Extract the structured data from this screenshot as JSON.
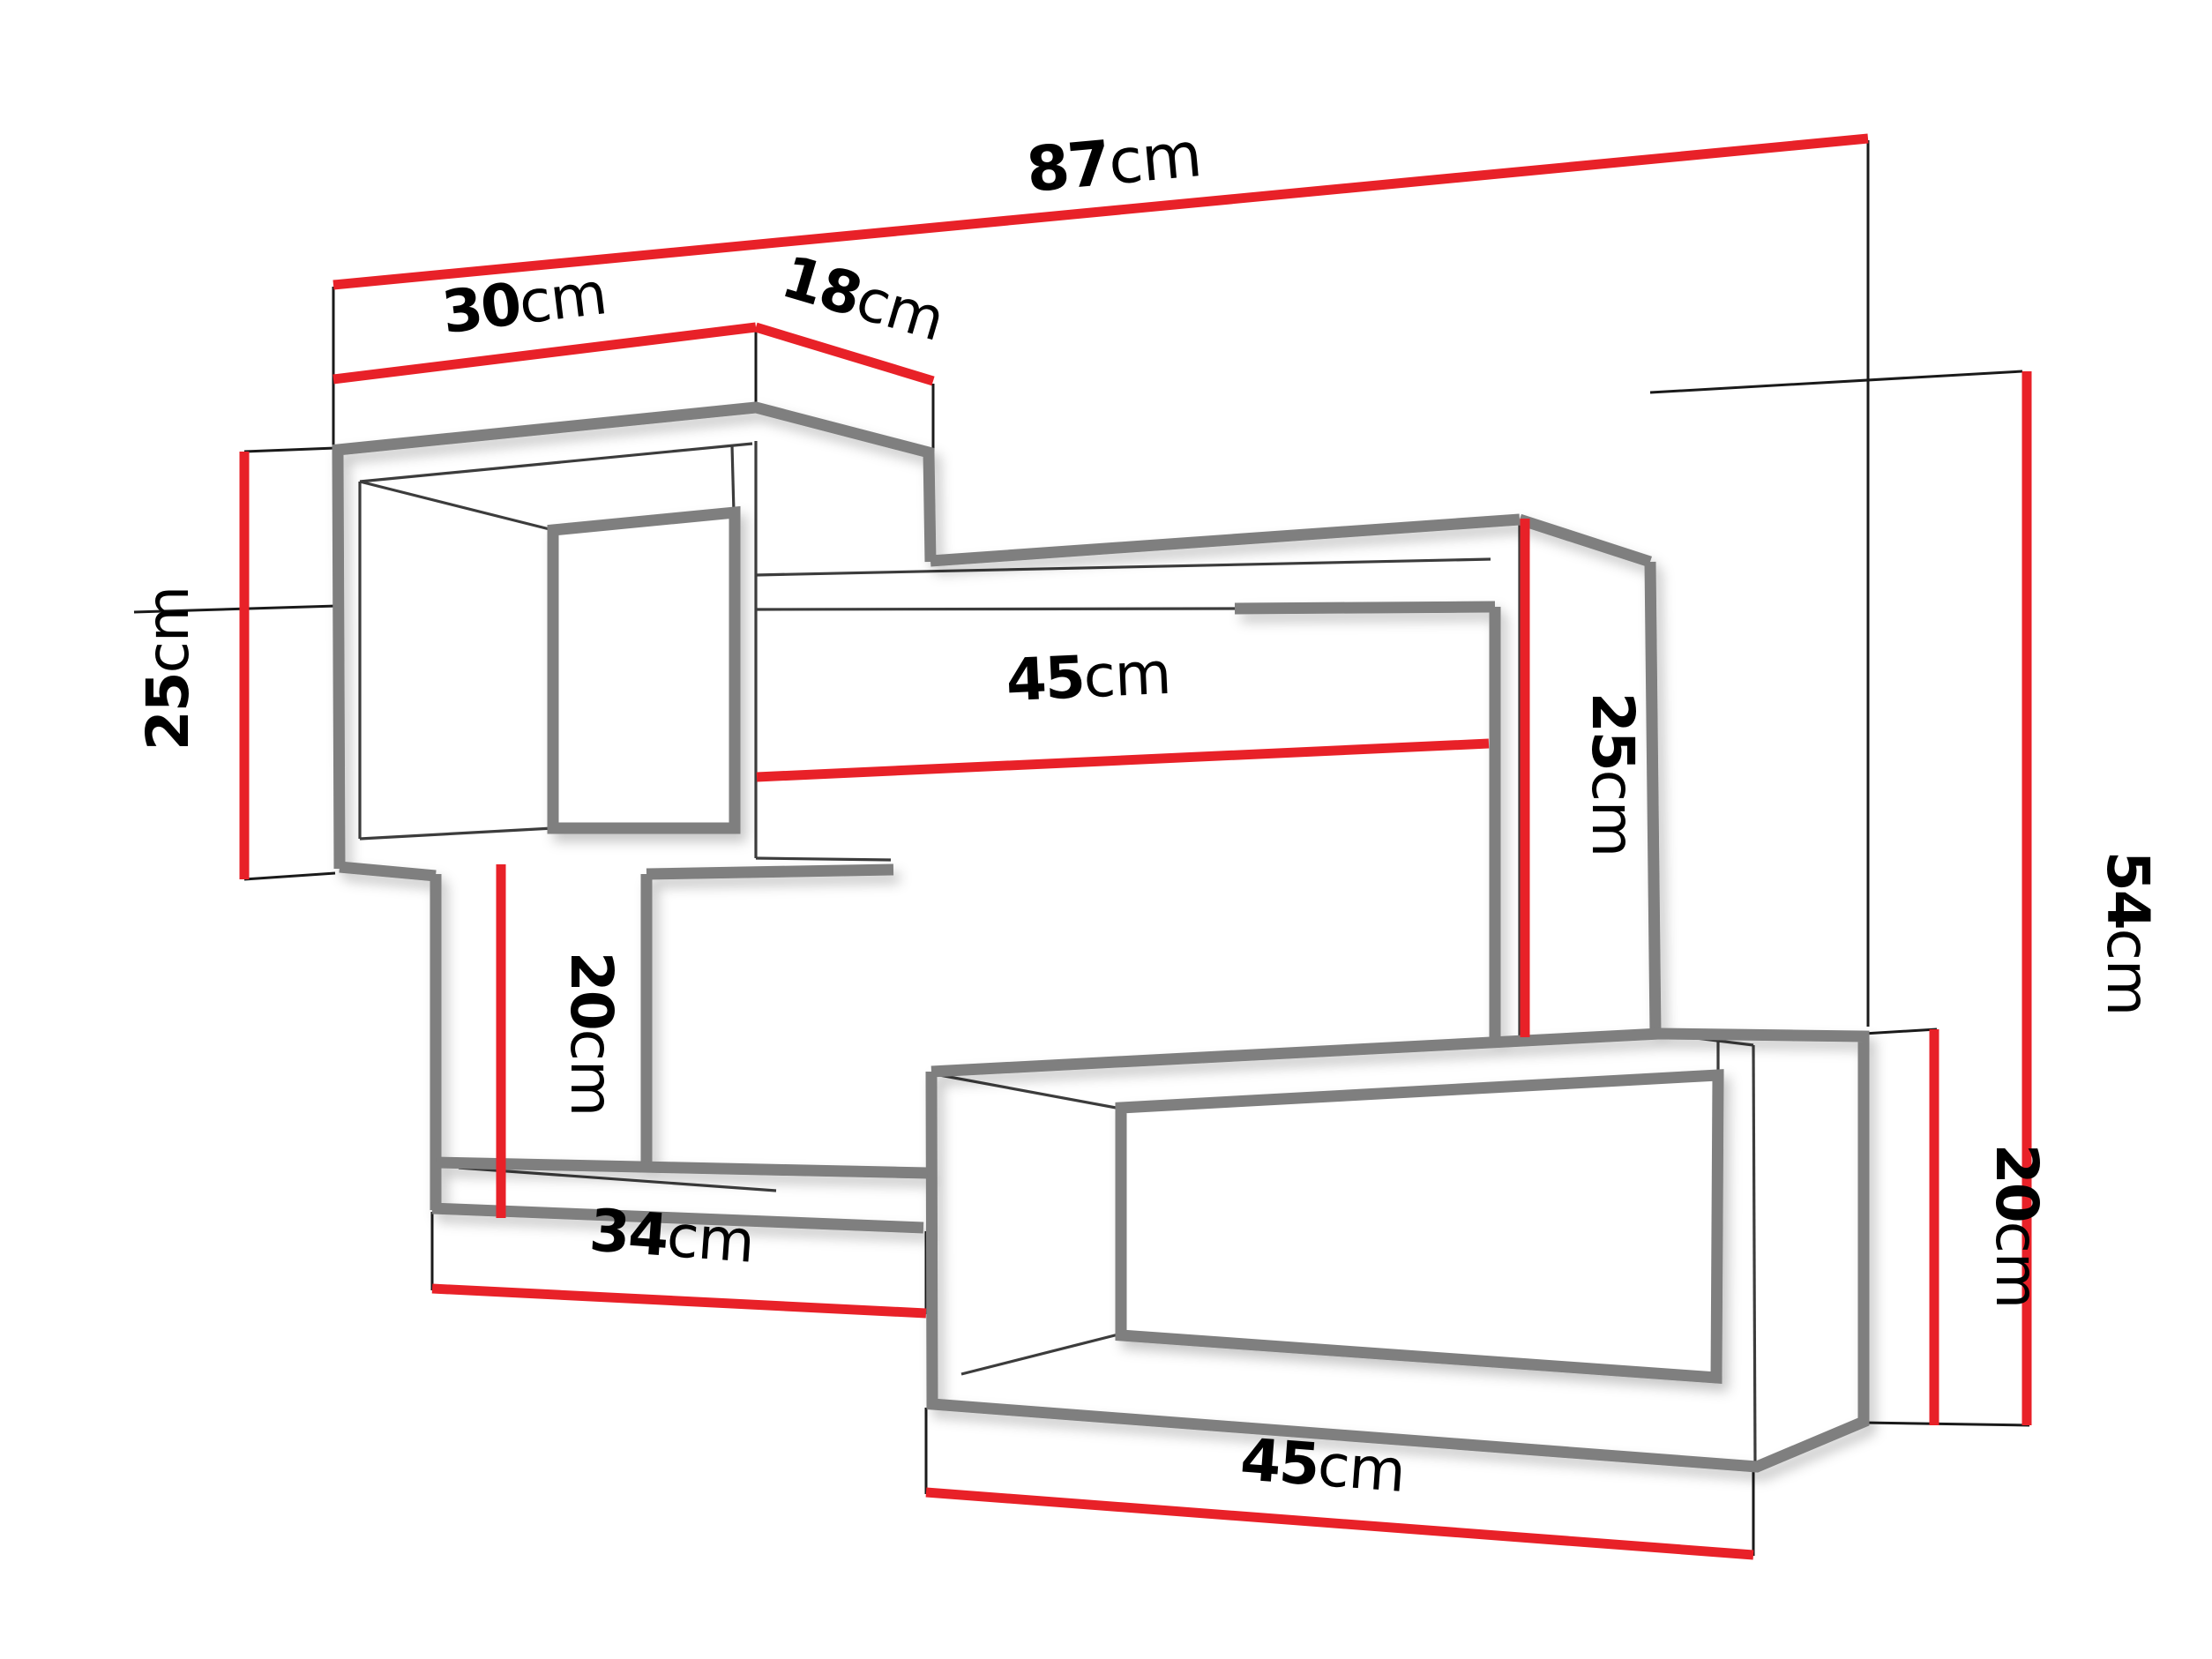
{
  "diagram": {
    "type": "furniture-dimension-drawing",
    "object": "wall-mounted shelf unit (two open boxes connected by boards, 3D perspective)",
    "unit": "cm",
    "dimensions": {
      "d87": {
        "num": "87",
        "unit": "cm",
        "meaning": "total width"
      },
      "d30": {
        "num": "30",
        "unit": "cm",
        "meaning": "left cube width"
      },
      "d18": {
        "num": "18",
        "unit": "cm",
        "meaning": "left cube depth"
      },
      "d25L": {
        "num": "25",
        "unit": "cm",
        "meaning": "left cube height"
      },
      "d45M": {
        "num": "45",
        "unit": "cm",
        "meaning": "middle opening width"
      },
      "d25M": {
        "num": "25",
        "unit": "cm",
        "meaning": "right drop height"
      },
      "d54": {
        "num": "54",
        "unit": "cm",
        "meaning": "total height"
      },
      "d20L": {
        "num": "20",
        "unit": "cm",
        "meaning": "left support height"
      },
      "d34": {
        "num": "34",
        "unit": "cm",
        "meaning": "lower board length"
      },
      "d20R": {
        "num": "20",
        "unit": "cm",
        "meaning": "bottom box height"
      },
      "d45B": {
        "num": "45",
        "unit": "cm",
        "meaning": "bottom box width"
      }
    },
    "colors": {
      "dimension_line": "#e82128",
      "structure_thick": "#7f7f7f",
      "structure_thin": "#3c3c3c",
      "extension_line": "#1a1a1a",
      "background": "#ffffff",
      "label_text": "#000000"
    }
  }
}
